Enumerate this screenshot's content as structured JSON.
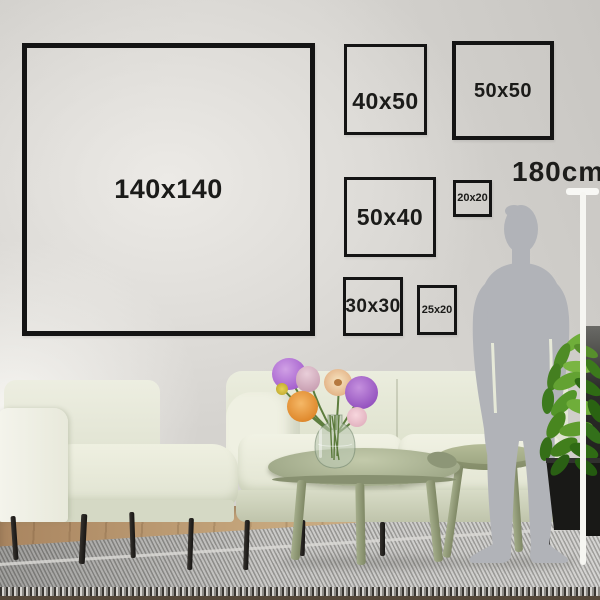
{
  "frames": [
    {
      "id": "140x140",
      "label": "140x140"
    },
    {
      "id": "40x50",
      "label": "40x50"
    },
    {
      "id": "50x50",
      "label": "50x50"
    },
    {
      "id": "50x40",
      "label": "50x40"
    },
    {
      "id": "20x20",
      "label": "20x20"
    },
    {
      "id": "30x30",
      "label": "30x30"
    },
    {
      "id": "25x20",
      "label": "25x20"
    }
  ],
  "measurement": {
    "height_label": "180cm"
  },
  "colors": {
    "wall": "#d5d3cf",
    "frame_border": "#141414",
    "label_text": "#1b1b19",
    "measure_line": "#f8f8f5",
    "silhouette": "#b1b3b8",
    "sofa": "#e7eada",
    "table_sage": "#a2ab8b",
    "rug_gray": "#b3b2af",
    "floor_wood": "#c6a77d",
    "plant_leaf": "#5f9c2e",
    "plant_pot": "#191917",
    "flower_purple": "#a763cf",
    "flower_orange": "#e08a2e",
    "flower_pink": "#dba6b6",
    "flower_yellow": "#c9b33a"
  }
}
